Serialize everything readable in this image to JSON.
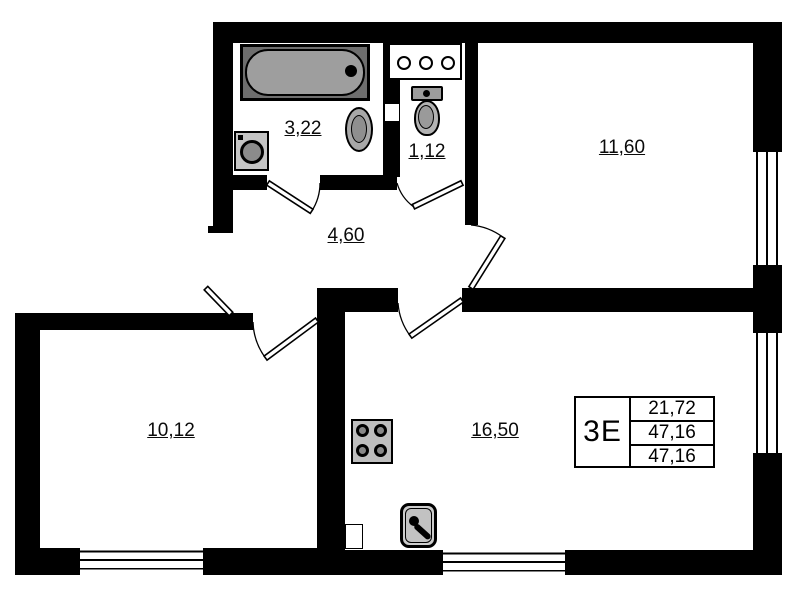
{
  "info_table": {
    "unit": "3Е",
    "rows": [
      "21,72",
      "47,16",
      "47,16"
    ]
  },
  "rooms": {
    "bathroom": {
      "area": "3,22"
    },
    "wc": {
      "area": "1,12"
    },
    "bedroom": {
      "area": "11,60"
    },
    "hallway": {
      "area": "4,60"
    },
    "room_left": {
      "area": "10,12"
    },
    "kitchen_living": {
      "area": "16,50"
    }
  },
  "colors": {
    "wall": "#000000",
    "background": "#ffffff",
    "fixture_fill": "#9e9e9e"
  }
}
